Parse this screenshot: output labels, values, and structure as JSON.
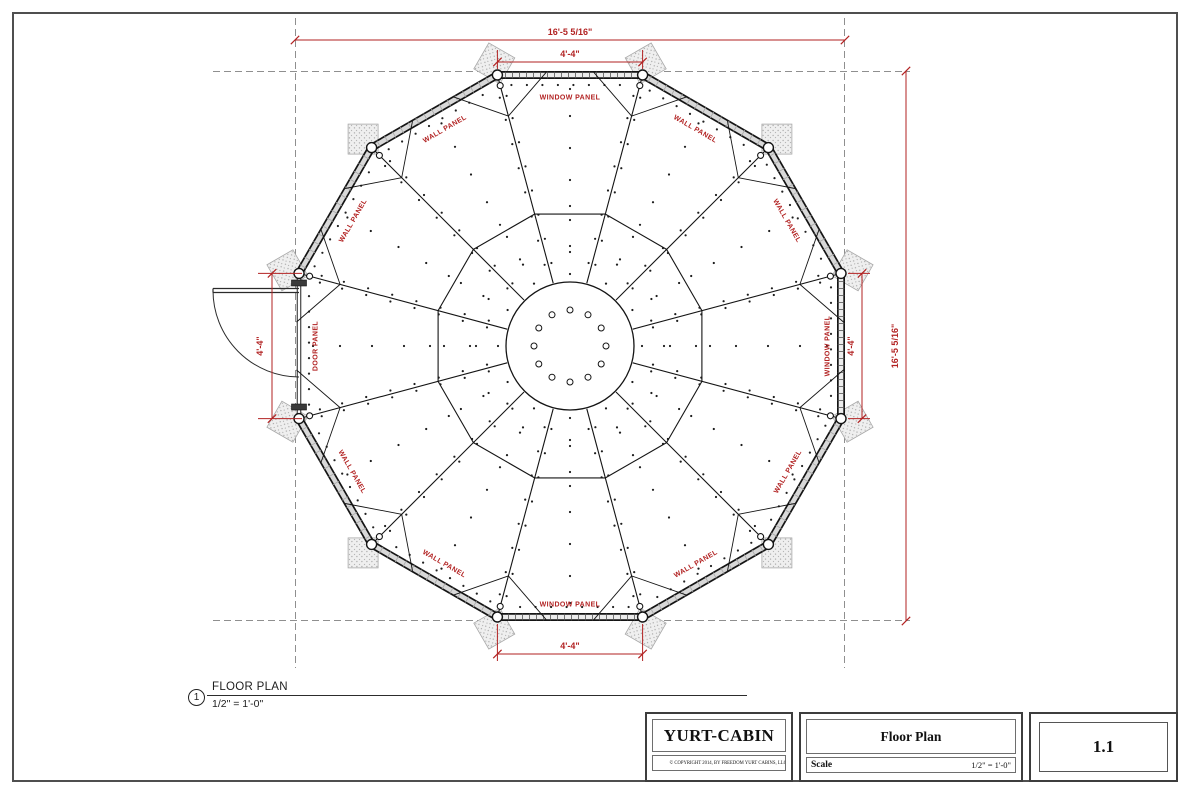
{
  "sheet": {
    "view": {
      "number": "1",
      "title": "FLOOR PLAN",
      "scale": "1/2\" = 1'-0\""
    },
    "title_block": {
      "company": "YURT-CABIN",
      "copyright": "© COPYRIGHT 2014, BY FREEDOM YURT CABINS, LLC.",
      "drawing_title": "Floor Plan",
      "scale_label": "Scale",
      "scale_value": "1/2\" = 1'-0\"",
      "sheet_number": "1.1"
    }
  },
  "plan": {
    "panels": [
      {
        "position": "top",
        "type": "window",
        "label": "WINDOW PANEL"
      },
      {
        "position": "top-right",
        "type": "wall",
        "label": "WALL PANEL"
      },
      {
        "position": "right-upper",
        "type": "wall",
        "label": "WALL PANEL"
      },
      {
        "position": "right",
        "type": "window",
        "label": "WINDOW PANEL"
      },
      {
        "position": "right-lower",
        "type": "wall",
        "label": "WALL PANEL"
      },
      {
        "position": "bottom-right",
        "type": "wall",
        "label": "WALL PANEL"
      },
      {
        "position": "bottom",
        "type": "window",
        "label": "WINDOW PANEL"
      },
      {
        "position": "bottom-left",
        "type": "wall",
        "label": "WALL PANEL"
      },
      {
        "position": "left-lower",
        "type": "wall",
        "label": "WALL PANEL"
      },
      {
        "position": "left",
        "type": "door",
        "label": "DOOR PANEL"
      },
      {
        "position": "left-upper",
        "type": "wall",
        "label": "WALL PANEL"
      },
      {
        "position": "top-left",
        "type": "wall",
        "label": "WALL PANEL"
      }
    ],
    "dimensions": {
      "overall_width": "16'-5 5/16\"",
      "overall_height": "16'-5 5/16\"",
      "top_window_width": "4'-4\"",
      "bottom_window_width": "4'-4\"",
      "right_window_height": "4'-4\"",
      "door_height": "4'-4\""
    },
    "colors": {
      "annotation_red": "#b22222",
      "dashed_gray": "#8f8f8f",
      "line_black": "#141414"
    }
  }
}
